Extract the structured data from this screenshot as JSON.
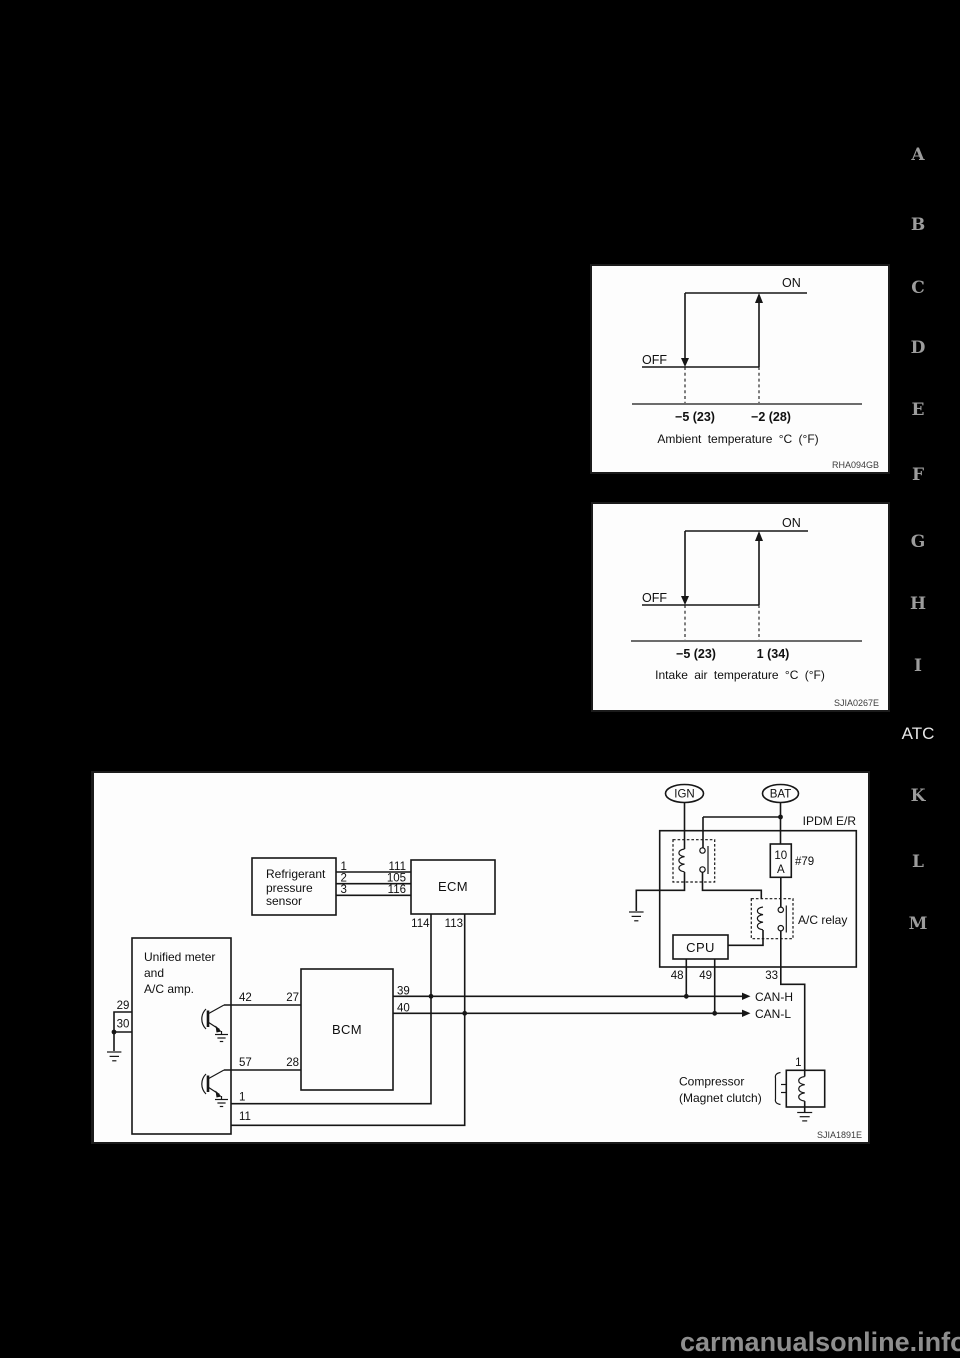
{
  "page": {
    "section_markers": [
      {
        "label": "A"
      },
      {
        "label": "B"
      },
      {
        "label": "C"
      },
      {
        "label": "D"
      },
      {
        "label": "E"
      },
      {
        "label": "F"
      },
      {
        "label": "G"
      },
      {
        "label": "H"
      },
      {
        "label": "I"
      },
      {
        "label": "ATC"
      },
      {
        "label": "K"
      },
      {
        "label": "L"
      },
      {
        "label": "M"
      }
    ],
    "watermark": "carmanualsonline.info"
  },
  "chart_data": [
    {
      "type": "line",
      "subtype": "hysteresis-step",
      "title": "Compressor ON/OFF vs ambient temperature",
      "xlabel": "Ambient temperature °C (°F)",
      "state_on": "ON",
      "state_off": "OFF",
      "x_ticks": [
        "−5 (23)",
        "−2 (28)"
      ],
      "transitions": [
        {
          "x": "−5 (23)",
          "change": "ON to OFF"
        },
        {
          "x": "−2 (28)",
          "change": "OFF to ON"
        }
      ],
      "figure_code": "RHA094GB"
    },
    {
      "type": "line",
      "subtype": "hysteresis-step",
      "title": "Compressor ON/OFF vs intake air temperature",
      "xlabel": "Intake air temperature °C (°F)",
      "state_on": "ON",
      "state_off": "OFF",
      "x_ticks": [
        "−5 (23)",
        "1 (34)"
      ],
      "transitions": [
        {
          "x": "−5 (23)",
          "change": "ON to OFF"
        },
        {
          "x": "1 (34)",
          "change": "OFF to ON"
        }
      ],
      "figure_code": "SJIA0267E"
    }
  ],
  "wiring_diagram": {
    "figure_code": "SJIA1891E",
    "power": {
      "ign": "IGN",
      "bat": "BAT"
    },
    "ipdm": {
      "label": "IPDM E/R",
      "fuse_line1": "10",
      "fuse_line2": "A",
      "fuse_number": "#79",
      "ac_relay_label": "A/C relay",
      "cpu_label": "CPU",
      "pin48": "48",
      "pin49": "49",
      "pin33": "33"
    },
    "sensor": {
      "line1": "Refrigerant",
      "line2": "pressure",
      "line3": "sensor",
      "pin1": "1",
      "pin2": "2",
      "pin3": "3"
    },
    "ecm": {
      "label": "ECM",
      "pin111": "111",
      "pin105": "105",
      "pin116": "116",
      "pin114": "114",
      "pin113": "113"
    },
    "unified": {
      "line1": "Unified meter",
      "line2": "and",
      "line3": "A/C amp.",
      "pin29": "29",
      "pin30": "30",
      "pin42": "42",
      "pin57": "57",
      "pin1": "1",
      "pin11": "11"
    },
    "bcm": {
      "label": "BCM",
      "pin27": "27",
      "pin28": "28",
      "pin39": "39",
      "pin40": "40"
    },
    "can": {
      "h": "CAN-H",
      "l": "CAN-L"
    },
    "compressor": {
      "line1": "Compressor",
      "line2": "(Magnet clutch)",
      "pin1": "1"
    }
  }
}
